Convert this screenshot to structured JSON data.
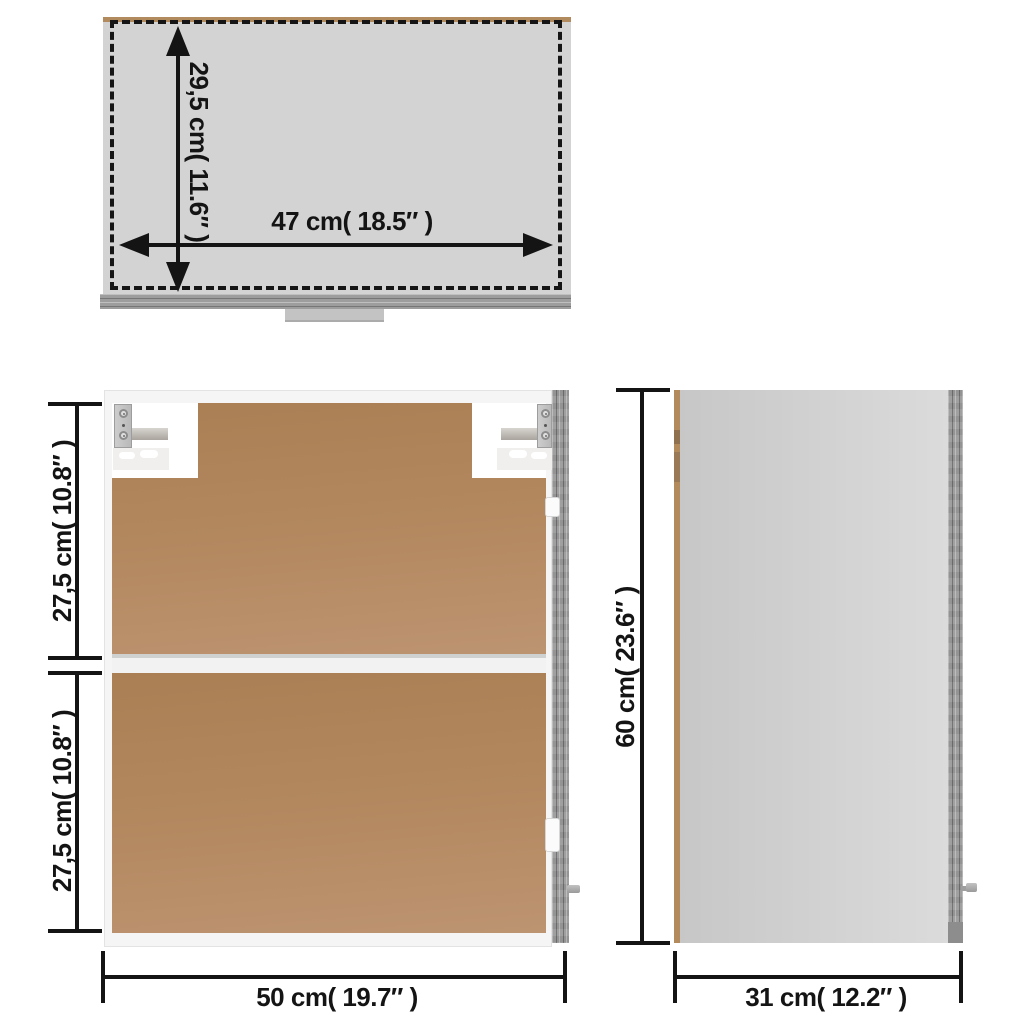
{
  "diagram": {
    "top_view": {
      "depth_label": "29,5 cm( 11.6″ )",
      "width_label": "47 cm( 18.5″ )"
    },
    "front_view": {
      "upper_height_label": "27,5 cm( 10.8″ )",
      "lower_height_label": "27,5 cm( 10.8″ )",
      "width_label": "50 cm( 19.7″ )"
    },
    "side_view": {
      "height_label": "60 cm( 23.6″ )",
      "depth_label": "31 cm( 12.2″ )"
    },
    "colors": {
      "dimension_ink": "#141414",
      "back_panel_brown": "#b2875f",
      "carcass_white": "#f5f5f5",
      "door_edge_gray": "#9d9d9d",
      "top_view_fill": "#d2d3d2",
      "wood_edge_tan": "#b18a5e"
    }
  }
}
